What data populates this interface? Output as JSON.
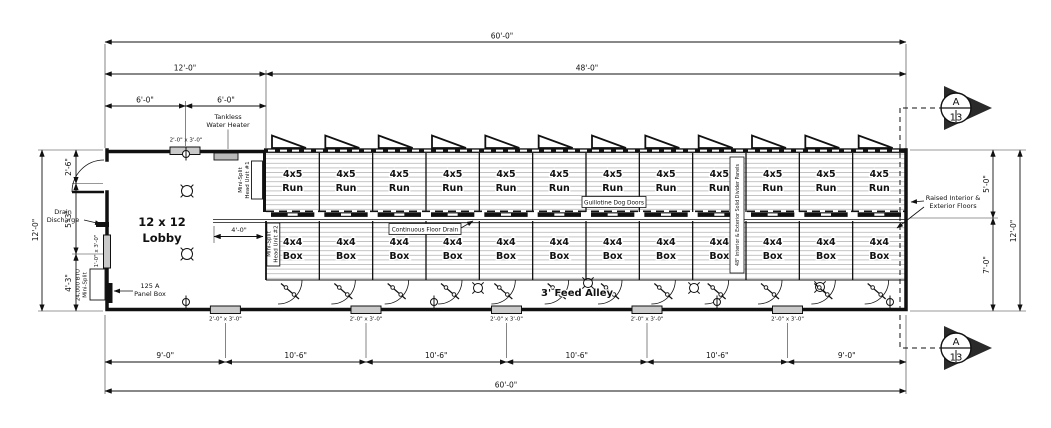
{
  "page": {
    "background": "#ffffff",
    "line_color": "#111111",
    "hatch_color": "#b5b5b5",
    "window_fill": "#c9c9c9"
  },
  "plan": {
    "lobby": {
      "line1": "12 x 12",
      "line2": "Lobby"
    },
    "feed_alley": "3' Feed Alley",
    "run_cell": {
      "line1": "4x5",
      "line2": "Run",
      "count": 12
    },
    "box_cell": {
      "line1": "4x4",
      "line2": "Box",
      "count": 12
    }
  },
  "dimensions": {
    "top": {
      "overall": "60'-0\"",
      "kennel": "48'-0\"",
      "lobby": "12'-0\"",
      "lobby_left": "6'-0\"",
      "lobby_right": "6'-0\""
    },
    "left": {
      "overall": "12'-0\"",
      "upper": "2'-6\"",
      "middle": "5'-3\"",
      "lower": "4'-3\""
    },
    "right": {
      "overall": "12'-0\"",
      "upper": "5'-0\"",
      "lower": "7'-0\""
    },
    "bottom": {
      "segments": [
        "9'-0\"",
        "10'-6\"",
        "10'-6\"",
        "10'-6\"",
        "10'-6\"",
        "9'-0\""
      ],
      "overall": "60'-0\""
    },
    "lobby_drain": "4'-0\""
  },
  "annotations": {
    "tankless": {
      "line1": "Tankless",
      "line2": "Water Heater"
    },
    "mini_split_1": {
      "line1": "Mini-Split",
      "line2": "Head Unit #1"
    },
    "mini_split_2": {
      "line1": "Mini-Split",
      "line2": "Head Unit #2"
    },
    "guillotine": "Guillotine Dog Doors",
    "floor_drain": "Continuous Floor Drain",
    "divider_panels": "48\" Interior & Exterior Solid Divider Panels",
    "raised_floors": {
      "line1": "Raised Interior &",
      "line2": "Exterior Floors"
    },
    "drain_discharge": {
      "line1": "Drain",
      "line2": "Discharge"
    },
    "panel_box": {
      "line1": "125 A",
      "line2": "Panel Box"
    },
    "btu_mini_split": {
      "line1": "24,000 BTU",
      "line2": "Mini-Split"
    }
  },
  "labels": {
    "window_2x3": "2'-0\" x 3'-0\"",
    "window_1x3": "1'-0\" x 3'-0\""
  },
  "section_marker": {
    "letter": "A",
    "sheet": "13"
  }
}
